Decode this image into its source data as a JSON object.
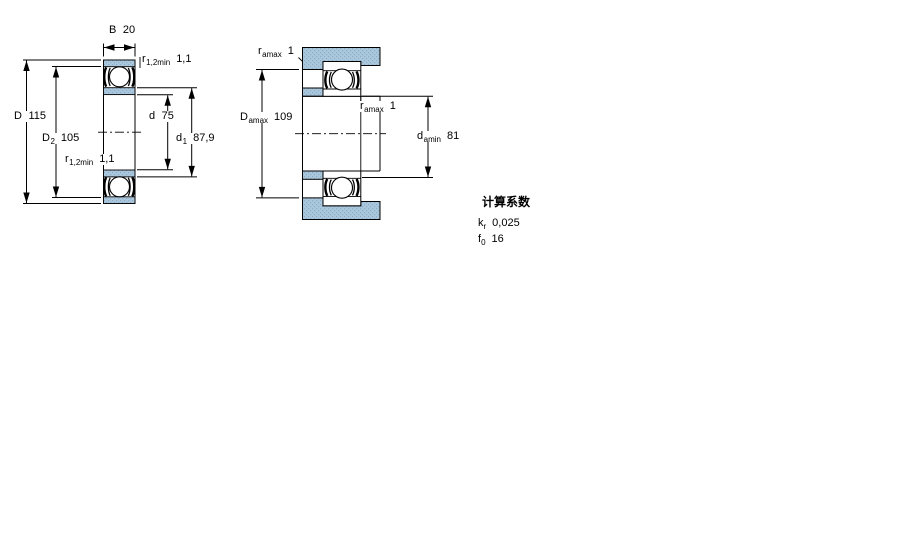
{
  "colors": {
    "section_fill": "#aac7dd",
    "section_fill_dots": "#8cadc6",
    "line": "#000000"
  },
  "diagram1": {
    "description": "bearing-cross-section",
    "dims": {
      "B": {
        "sym": "B",
        "val": "20"
      },
      "r12_top": {
        "sym": "r",
        "sub": "1,2min",
        "val": "1,1"
      },
      "D": {
        "sym": "D",
        "val": "115"
      },
      "D2": {
        "sym": "D",
        "sub": "2",
        "val": "105"
      },
      "d": {
        "sym": "d",
        "val": "75"
      },
      "d1": {
        "sym": "d",
        "sub": "1",
        "val": "87,9"
      },
      "r12_bottom": {
        "sym": "r",
        "sub": "1,2min",
        "val": "1,1"
      }
    }
  },
  "diagram2": {
    "description": "abutment-dimensions",
    "dims": {
      "ra_top": {
        "sym": "r",
        "sub": "amax",
        "val": "1"
      },
      "Da": {
        "sym": "D",
        "sub": "amax",
        "val": "109"
      },
      "ra_mid": {
        "sym": "r",
        "sub": "amax",
        "val": "1"
      },
      "da": {
        "sym": "d",
        "sub": "amin",
        "val": "81"
      }
    }
  },
  "calculation_factors": {
    "heading": "计算系数",
    "kr": {
      "sym": "k",
      "sub": "r",
      "val": "0,025"
    },
    "f0": {
      "sym": "f",
      "sub": "0",
      "val": "16"
    }
  }
}
